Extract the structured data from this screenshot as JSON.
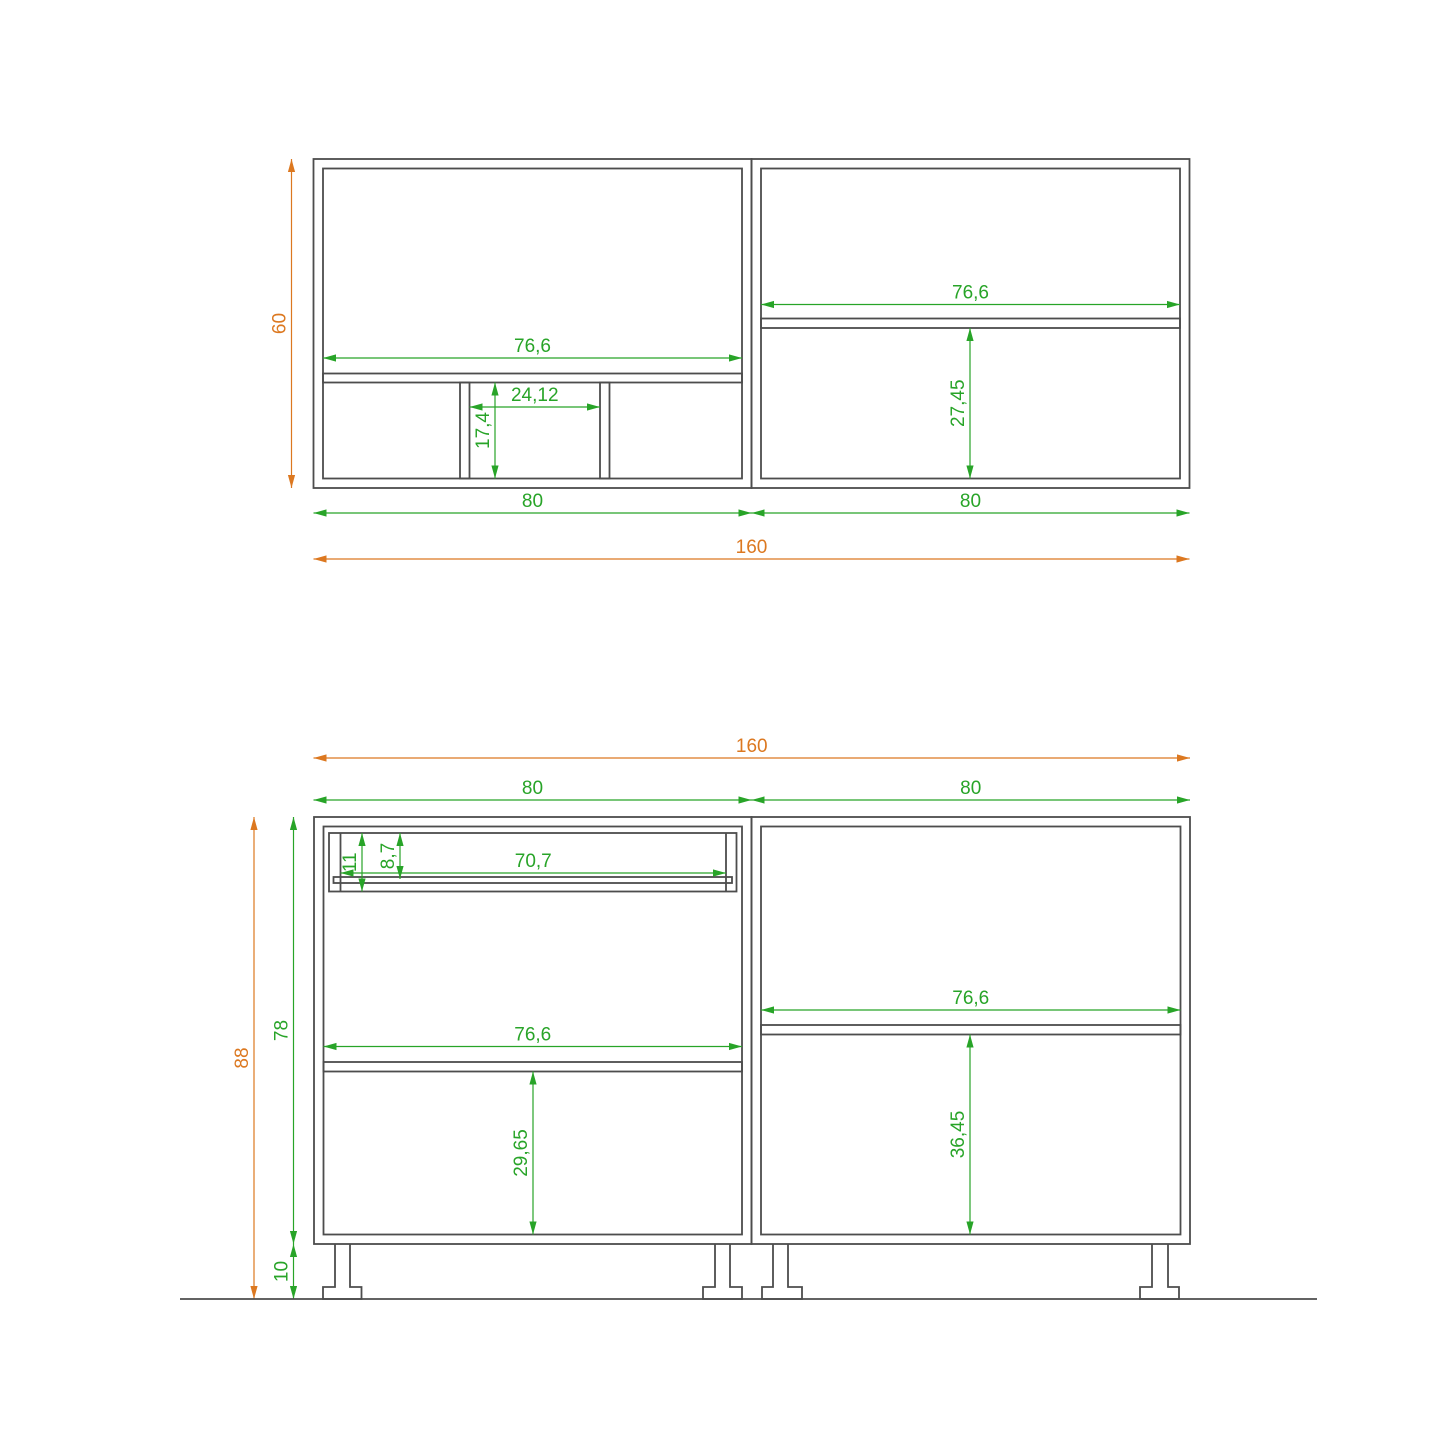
{
  "drawing": {
    "background": "#ffffff",
    "colors": {
      "outline": "#4d4d4d",
      "green": "#28a428",
      "orange": "#dc7820"
    },
    "stroke": {
      "outline": 1.8,
      "dim": 1.2
    },
    "arrow": {
      "len": 13,
      "half": 3.6
    },
    "label_gap": 6,
    "font_size": 19,
    "floor_line": {
      "x1": 180,
      "y1": 1299,
      "x2": 1317,
      "y2": 1299
    },
    "views": [
      {
        "name": "wall-cabinets-elevation",
        "boxes": [
          {
            "name": "left-wall-cabinet-outer",
            "x": 313.5,
            "y": 159,
            "w": 438,
            "h": 329
          },
          {
            "name": "left-wall-cabinet-inner",
            "x": 323,
            "y": 168.5,
            "w": 419,
            "h": 310
          },
          {
            "name": "left-wall-cabinet-shelf",
            "x": 323,
            "y": 373.5,
            "w": 419,
            "h": 9
          },
          {
            "name": "left-wall-divider-1",
            "x": 460,
            "y": 382.5,
            "w": 9.5,
            "h": 96
          },
          {
            "name": "left-wall-divider-2",
            "x": 600,
            "y": 382.5,
            "w": 9.5,
            "h": 96
          },
          {
            "name": "right-wall-cabinet-outer",
            "x": 751.5,
            "y": 159,
            "w": 438,
            "h": 329
          },
          {
            "name": "right-wall-cabinet-inner",
            "x": 761,
            "y": 168.5,
            "w": 419,
            "h": 310
          },
          {
            "name": "right-wall-cabinet-shelf",
            "x": 761,
            "y": 318.5,
            "w": 419,
            "h": 9.5
          }
        ],
        "lines": [],
        "legs": [],
        "dims": [
          {
            "label": "60",
            "color": "orange",
            "dir": "v",
            "at": 291.5,
            "from": 159,
            "to": 488
          },
          {
            "label": "76,6",
            "color": "green",
            "dir": "h",
            "at": 358,
            "from": 323,
            "to": 742
          },
          {
            "label": "24,12",
            "color": "green",
            "dir": "h",
            "at": 407,
            "from": 469.5,
            "to": 600
          },
          {
            "label": "17,4",
            "color": "green",
            "dir": "v",
            "at": 495,
            "from": 382.5,
            "to": 478.5
          },
          {
            "label": "76,6",
            "color": "green",
            "dir": "h",
            "at": 304.5,
            "from": 761,
            "to": 1180
          },
          {
            "label": "27,45",
            "color": "green",
            "dir": "v",
            "at": 970,
            "from": 328,
            "to": 478.5
          },
          {
            "label": "80",
            "color": "green",
            "dir": "h",
            "at": 513,
            "from": 313.5,
            "to": 751.5
          },
          {
            "label": "80",
            "color": "green",
            "dir": "h",
            "at": 513,
            "from": 751.5,
            "to": 1189.5
          },
          {
            "label": "160",
            "color": "orange",
            "dir": "h",
            "at": 559,
            "from": 313.5,
            "to": 1189.5
          }
        ]
      },
      {
        "name": "base-cabinets-elevation",
        "boxes": [
          {
            "name": "left-base-cabinet-outer",
            "x": 314,
            "y": 817,
            "w": 437.5,
            "h": 427
          },
          {
            "name": "left-base-cabinet-inner",
            "x": 323.5,
            "y": 826.5,
            "w": 418.5,
            "h": 408
          },
          {
            "name": "drawer-box",
            "x": 329,
            "y": 833,
            "w": 407.5,
            "h": 58.5
          },
          {
            "name": "drawer-bottom-rail",
            "x": 333.5,
            "y": 877,
            "w": 398.5,
            "h": 6
          },
          {
            "name": "left-base-cabinet-shelf",
            "x": 323.5,
            "y": 1062,
            "w": 418.5,
            "h": 9.5
          },
          {
            "name": "right-base-cabinet-outer",
            "x": 751.5,
            "y": 817,
            "w": 438.5,
            "h": 427
          },
          {
            "name": "right-base-cabinet-inner",
            "x": 761,
            "y": 826.5,
            "w": 419.5,
            "h": 408
          },
          {
            "name": "right-base-cabinet-shelf",
            "x": 761,
            "y": 1025,
            "w": 419.5,
            "h": 9.5
          }
        ],
        "lines": [
          {
            "name": "drawer-side-wall-left",
            "x1": 340.5,
            "y1": 833,
            "x2": 340.5,
            "y2": 891.5
          },
          {
            "name": "drawer-side-wall-right",
            "x1": 726,
            "y1": 833,
            "x2": 726,
            "y2": 891.5
          }
        ],
        "legs": [
          {
            "name": "leg-left-cabinet-left",
            "stem_x1": 335,
            "stem_x2": 350,
            "foot_x1": 323,
            "foot_x2": 361.5,
            "top": 1244,
            "foot_top": 1287,
            "bottom": 1299
          },
          {
            "name": "leg-left-cabinet-right",
            "stem_x1": 715,
            "stem_x2": 730,
            "foot_x1": 703,
            "foot_x2": 742,
            "top": 1244,
            "foot_top": 1287,
            "bottom": 1299
          },
          {
            "name": "leg-right-cabinet-left",
            "stem_x1": 773,
            "stem_x2": 788,
            "foot_x1": 762,
            "foot_x2": 802,
            "top": 1244,
            "foot_top": 1287,
            "bottom": 1299
          },
          {
            "name": "leg-right-cabinet-right",
            "stem_x1": 1152,
            "stem_x2": 1168,
            "foot_x1": 1140,
            "foot_x2": 1179,
            "top": 1244,
            "foot_top": 1287,
            "bottom": 1299
          }
        ],
        "dims": [
          {
            "label": "160",
            "color": "orange",
            "dir": "h",
            "at": 758,
            "from": 313.5,
            "to": 1190
          },
          {
            "label": "80",
            "color": "green",
            "dir": "h",
            "at": 800,
            "from": 313.5,
            "to": 751.5
          },
          {
            "label": "80",
            "color": "green",
            "dir": "h",
            "at": 800,
            "from": 751.5,
            "to": 1190
          },
          {
            "label": "88",
            "color": "orange",
            "dir": "v",
            "at": 254,
            "from": 817,
            "to": 1299
          },
          {
            "label": "78",
            "color": "green",
            "dir": "v",
            "at": 293.5,
            "from": 817,
            "to": 1244
          },
          {
            "label": "10",
            "color": "green",
            "dir": "v",
            "at": 293.5,
            "from": 1244,
            "to": 1299
          },
          {
            "label": "11",
            "color": "green",
            "dir": "v",
            "at": 362,
            "from": 833,
            "to": 891.5
          },
          {
            "label": "8,7",
            "color": "green",
            "dir": "v",
            "at": 400,
            "from": 833,
            "to": 879
          },
          {
            "label": "70,7",
            "color": "green",
            "dir": "h",
            "at": 873,
            "from": 340.5,
            "to": 726
          },
          {
            "label": "76,6",
            "color": "green",
            "dir": "h",
            "at": 1046.5,
            "from": 323.5,
            "to": 742
          },
          {
            "label": "29,65",
            "color": "green",
            "dir": "v",
            "at": 533,
            "from": 1071.5,
            "to": 1234.5
          },
          {
            "label": "76,6",
            "color": "green",
            "dir": "h",
            "at": 1010,
            "from": 761,
            "to": 1180.5
          },
          {
            "label": "36,45",
            "color": "green",
            "dir": "v",
            "at": 970,
            "from": 1034.5,
            "to": 1234.5
          }
        ]
      }
    ]
  }
}
